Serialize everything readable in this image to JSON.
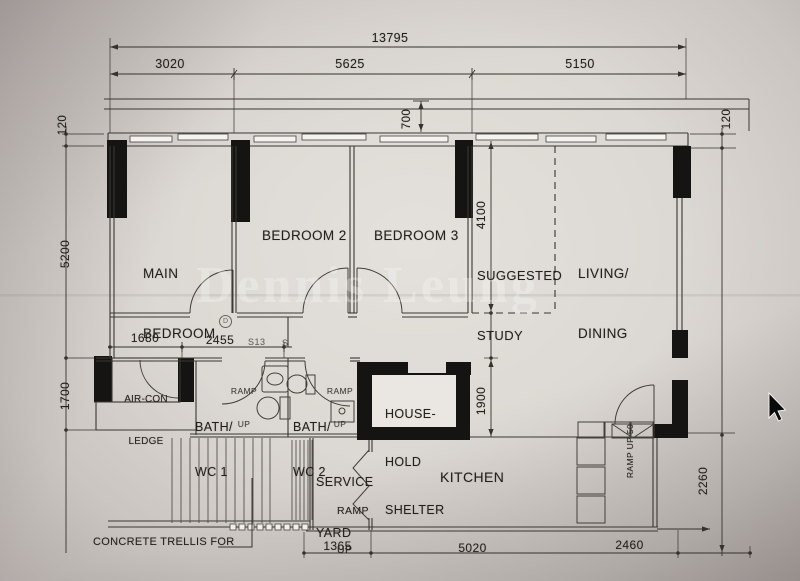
{
  "watermark": "Dennis Leung",
  "dimensions": {
    "top_total": "13795",
    "top_left": "3020",
    "top_mid": "5625",
    "top_right": "5150",
    "ledge_depth": "700",
    "left_offset": "120",
    "left_upper": "5200",
    "left_lower": "1700",
    "right_offset": "120",
    "right_lower": "2260",
    "study_depth": "4100",
    "shelter_height": "1900",
    "corridor_a": "1680",
    "corridor_b": "2455",
    "bottom_left": "1365",
    "bottom_mid": "5020",
    "bottom_right": "2460",
    "tag_a": "S13",
    "tag_b": "S",
    "tag_circle": "D"
  },
  "rooms": {
    "main_bedroom": [
      "MAIN",
      "BEDROOM"
    ],
    "bedroom2": "BEDROOM 2",
    "bedroom3": "BEDROOM 3",
    "study": [
      "SUGGESTED",
      "STUDY"
    ],
    "living": [
      "LIVING/",
      "DINING"
    ],
    "aircon": [
      "AIR-CON",
      "LEDGE"
    ],
    "bath1": [
      "BATH/",
      "WC 1"
    ],
    "bath2": [
      "BATH/",
      "WC 2"
    ],
    "shelter": [
      "HOUSE-",
      "HOLD",
      "SHELTER"
    ],
    "service_yard": [
      "SERVICE",
      "YARD"
    ],
    "kitchen": "KITCHEN"
  },
  "annotations": {
    "ramp_bath1": [
      "RAMP",
      "UP"
    ],
    "ramp_bath2": [
      "RAMP",
      "UP"
    ],
    "ramp_service": [
      "RAMP",
      "UP"
    ],
    "ramp_entry": [
      "RAMP",
      "UP 50"
    ],
    "trellis": "CONCRETE TRELLIS FOR"
  }
}
